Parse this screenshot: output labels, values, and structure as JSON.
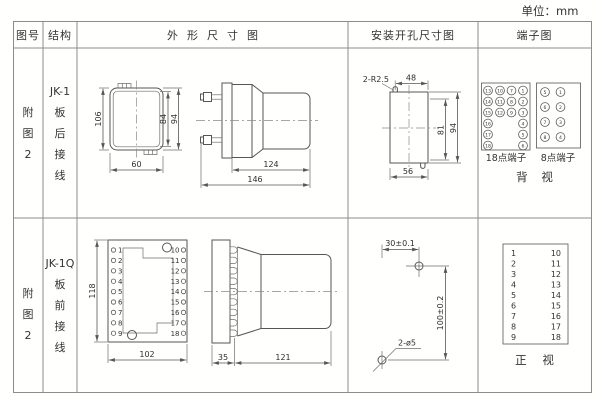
{
  "unit_label": "单位：mm",
  "columns": {
    "figure_no": "图号",
    "structure": "结构",
    "outline": "外形尺寸图",
    "mounting": "安装开孔尺寸图",
    "terminal": "端子图"
  },
  "row1": {
    "figure_no": [
      "附",
      "图",
      "2"
    ],
    "structure": [
      "JK-1",
      "板",
      "后",
      "接",
      "线"
    ],
    "outline_front": {
      "height_left": "106",
      "inner_height": "84",
      "outer_height": "94",
      "width": "60"
    },
    "outline_side": {
      "body_length": "124",
      "total_length": "146"
    },
    "mounting": {
      "slot_note": "2-R2.5",
      "top_width": "48",
      "inner_height": "81",
      "full_height": "94",
      "bottom_width": "56"
    },
    "terminal18": {
      "label": "18点端子",
      "columns": [
        [
          "13",
          "14",
          "15",
          "16",
          "17",
          "18"
        ],
        [
          "10",
          "11",
          "12"
        ],
        [
          "7",
          "8",
          "9"
        ],
        [
          "1",
          "2",
          "3",
          "4",
          "5",
          "6"
        ]
      ]
    },
    "terminal8": {
      "label": "8点端子",
      "left": [
        "5",
        "6",
        "7",
        "8"
      ],
      "right": [
        "1",
        "2",
        "3",
        "4"
      ]
    },
    "view_label": "背 视"
  },
  "row2": {
    "figure_no": [
      "附",
      "图",
      "2"
    ],
    "structure": [
      "JK-1Q",
      "板",
      "前",
      "接",
      "线"
    ],
    "outline_front": {
      "height": "118",
      "width": "102"
    },
    "outline_side": {
      "panel_depth": "35",
      "body_length": "121"
    },
    "mounting": {
      "h_distance": "30±0.1",
      "v_distance": "100±0.2",
      "hole_note": "2-ø5"
    },
    "terminals": {
      "left": [
        "1",
        "2",
        "3",
        "4",
        "5",
        "6",
        "7",
        "8",
        "9"
      ],
      "right": [
        "10",
        "11",
        "12",
        "13",
        "14",
        "15",
        "16",
        "17",
        "18"
      ]
    },
    "view_label": "正 视"
  }
}
